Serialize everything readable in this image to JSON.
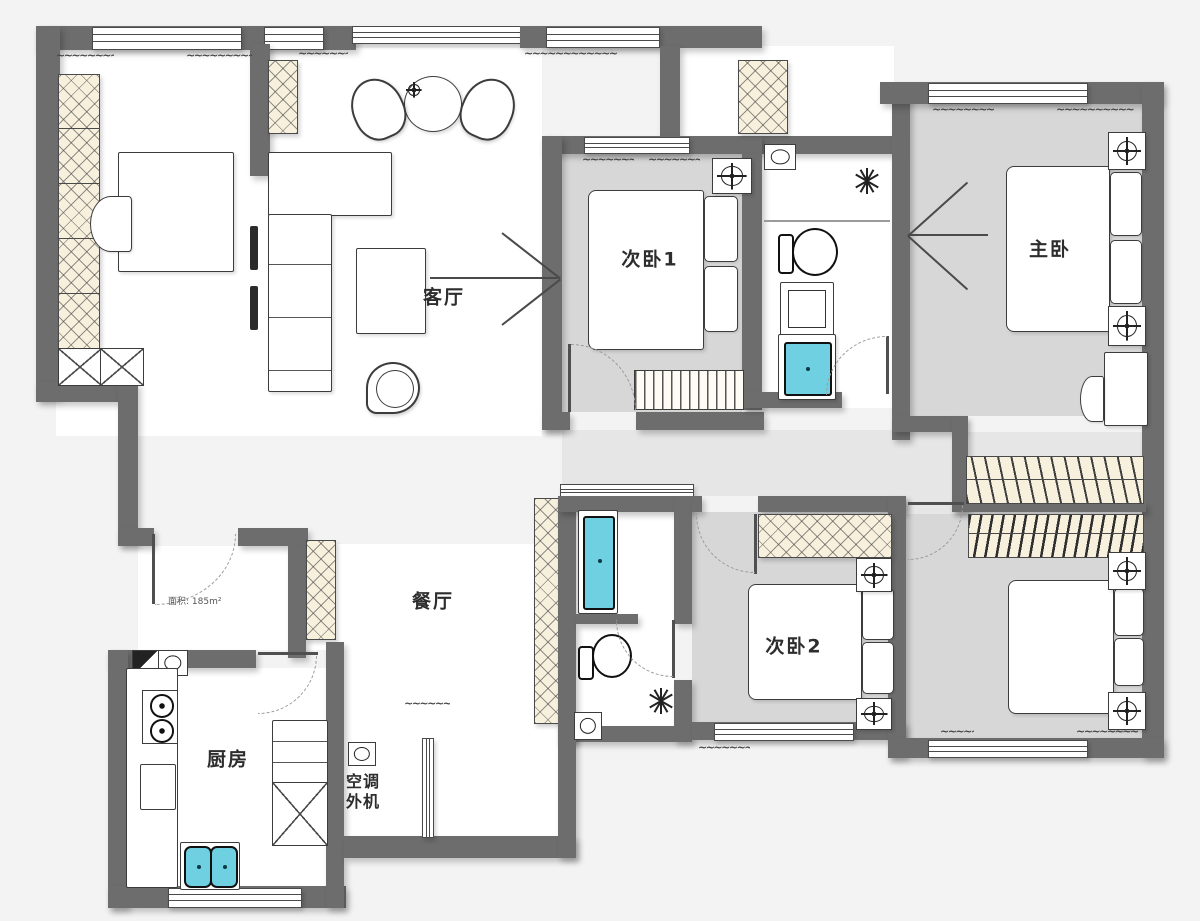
{
  "rooms": {
    "living": {
      "label": "客厅"
    },
    "bedroom1": {
      "label": "次卧1"
    },
    "master": {
      "label": "主卧"
    },
    "dining": {
      "label": "餐厅"
    },
    "kitchen": {
      "label": "厨房"
    },
    "bedroom2": {
      "label": "次卧2"
    },
    "ac": {
      "label_line1": "空调",
      "label_line2": "外机"
    }
  },
  "notes": {
    "area": "面积: 185m²"
  },
  "decor": {
    "squiggle": "~~~~~~~~~~~~"
  },
  "colors": {
    "wall": "#6d6d6d",
    "floor": "#d7d7d7",
    "hall": "#e6e6e6",
    "cyan": "#6fd0e2",
    "hatch": "#f7f0dd",
    "ink": "#3c3c3c",
    "bg": "#f3f3f3"
  }
}
